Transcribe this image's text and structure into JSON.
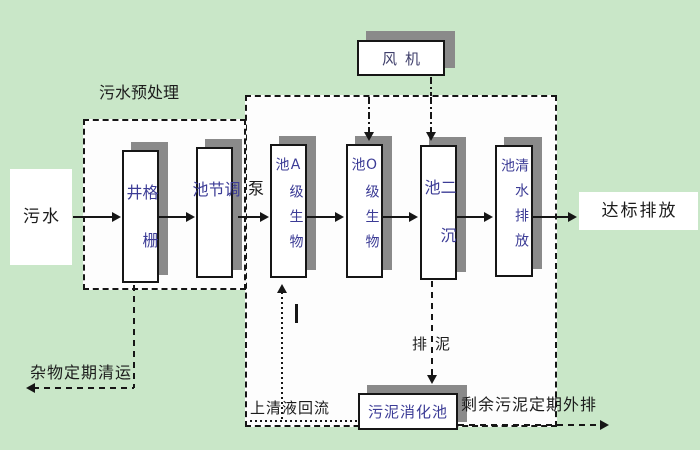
{
  "colors": {
    "background": "#c9e7c8",
    "panel_fill": "#fdfdfd",
    "border": "#161616",
    "shadow": "#8a8a8a",
    "process_text": "#3c3c96",
    "fan_text": "#3f3f6b",
    "label_text": "#1c1c1c"
  },
  "nodes": {
    "influent": "污水",
    "grid_well": "格栅井",
    "regulating_tank": "调节池",
    "pump": "泵",
    "a_bio_tank": "A级生物池",
    "o_bio_tank": "O级生物池",
    "secondary_clarifier": "二沉池",
    "clean_water_tank": "清水排放池",
    "fan": "风机",
    "sludge_digestion_tank": "污泥消化池",
    "effluent": "达标排放"
  },
  "annotations": {
    "pretreatment_group": "污水预处理",
    "debris_removal": "杂物定期清运",
    "supernatant_return": "上清液回流",
    "sludge_discharge": "排泥",
    "excess_sludge_out": "剩余污泥定期外排"
  }
}
